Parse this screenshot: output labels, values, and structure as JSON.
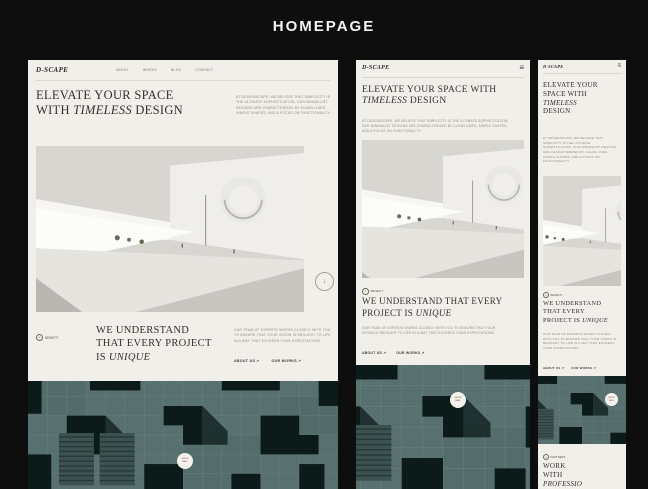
{
  "page": {
    "title": "HOMEPAGE"
  },
  "brand": {
    "logo": "D-SCAPE"
  },
  "nav": {
    "items": [
      {
        "label": "ABOUT"
      },
      {
        "label": "WORKS"
      },
      {
        "label": "BLOG"
      },
      {
        "label": "CONTACT"
      }
    ]
  },
  "icons": {
    "menu": "≡",
    "link_arrow": "↗",
    "scroll_down": "↓",
    "badge_plus": "+"
  },
  "hero": {
    "headline_part1": "ELEVATE YOUR SPACE WITH",
    "headline_italic": "TIMELESS",
    "headline_part2": "DESIGN",
    "intro": "AT DESIGNSCAPE, WE BELIEVE THAT SIMPLICITY IS THE ULTIMATE SOPHISTICATION. OUR MINIMALIST DESIGNS ARE CHARACTERIZED BY CLEAN LINES, SIMPLE SHAPES, AND A FOCUS ON FUNCTIONALITY."
  },
  "benefit": {
    "badge_label": "BENEFIT",
    "headline_part1": "WE UNDERSTAND THAT EVERY PROJECT IS",
    "headline_italic": "UNIQUE",
    "body": "OUR TEAM OF EXPERTS WORKS CLOSELY WITH YOU TO ENSURE THAT YOUR VISION IS BROUGHT TO LIFE IN A WAY THAT EXCEEDS YOUR EXPECTATIONS.",
    "link_about": "ABOUT US",
    "link_works": "OUR WORKS"
  },
  "showreel": {
    "line1": "SHOW",
    "line2": "REEL"
  },
  "partners": {
    "badge_label": "PARTNERS",
    "headline_part1": "WORK WITH",
    "headline_italic": "PROFESSIO"
  },
  "colors": {
    "artboard_bg": "#f1efea",
    "wall_base": "#587170",
    "wall_dark": "#0c1b1a"
  }
}
